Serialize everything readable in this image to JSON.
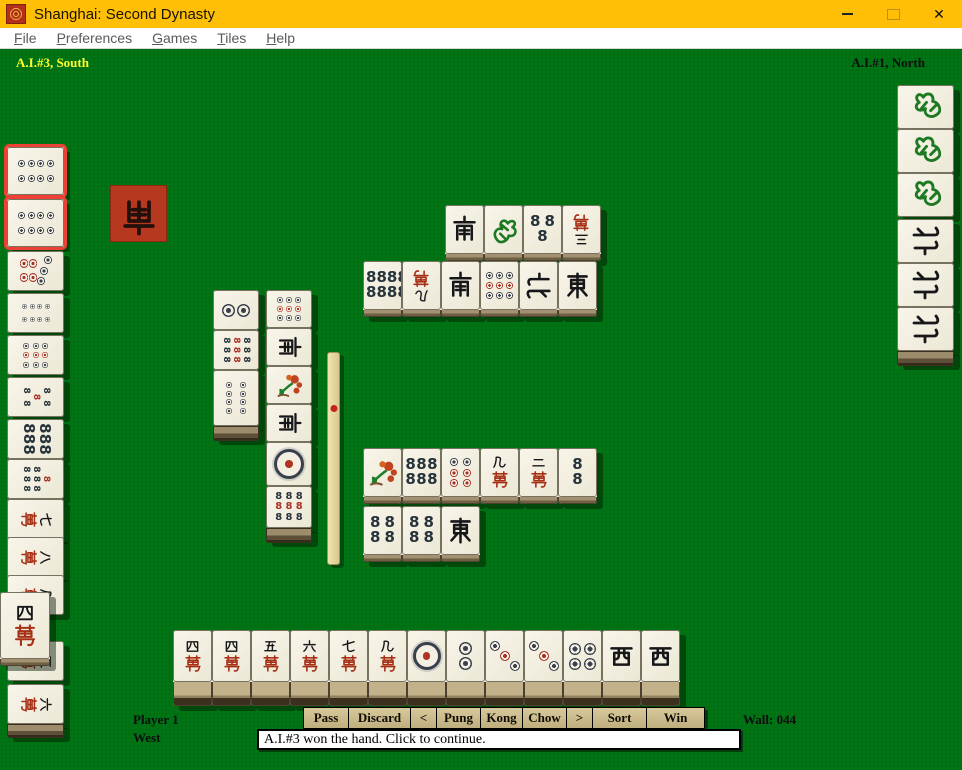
{
  "window": {
    "title": "Shanghai: Second Dynasty",
    "controls": [
      {
        "name": "minimize"
      },
      {
        "name": "maximize"
      },
      {
        "name": "close"
      }
    ]
  },
  "menu": {
    "items": [
      "File",
      "Preferences",
      "Games",
      "Tiles",
      "Help"
    ]
  },
  "hud": {
    "south_label": "A.I.#3, South",
    "north_label": "A.I.#1, North",
    "player_name": "Player 1",
    "player_wind": "West",
    "wall_label": "Wall: 044"
  },
  "actions": {
    "buttons": [
      "Pass",
      "Discard",
      "<",
      "Pung",
      "Kong",
      "Chow",
      ">",
      "Sort",
      "Win"
    ]
  },
  "status": {
    "message": "A.I.#3 won the hand. Click to continue."
  },
  "colors": {
    "felt": "#007314",
    "titlebar": "#ffbf06",
    "button_face": "#c9b88a",
    "tile_face": "#f2efe0",
    "highlight_red": "#ee4135",
    "indicator_red": "#b5381f",
    "glyph_red": "#a63117",
    "glyph_green": "#1d7a23"
  },
  "legend": {
    "m1": "1-man",
    "m2": "2-man",
    "m3": "3-man",
    "m4": "4-man",
    "m5": "5-man",
    "m6": "6-man",
    "m7": "7-man",
    "m8": "8-man",
    "m9": "9-man",
    "d1": "1-dot",
    "d2": "2-dot",
    "d3": "3-dot",
    "d4": "4-dot",
    "d6": "6-dot",
    "d7": "7-dot",
    "d8": "8-dot",
    "d9": "9-dot",
    "b2": "2-bamboo",
    "b3": "3-bamboo",
    "b4": "4-bamboo",
    "b5": "5-bamboo",
    "b6": "6-bamboo",
    "b7": "7-bamboo",
    "b8": "8-bamboo",
    "b9": "9-bamboo",
    "E": "east-wind",
    "S": "south-wind",
    "W": "west-wind",
    "N": "north-wind",
    "F": "green-dragon",
    "FL": "flower"
  },
  "indicator": {
    "x": 110,
    "y": 185,
    "size": 57,
    "face": "S",
    "rot": 180
  },
  "stick": {
    "x": 327,
    "y": 352,
    "w": 13,
    "h": 213,
    "dot_offset": 52
  },
  "tile_groups": [
    {
      "name": "south-exposed-hand",
      "kind": "stack",
      "tile_w": 57,
      "tile_h": 40,
      "rot": 90,
      "interactable": false,
      "tiles": [
        {
          "x": 7,
          "y": 147,
          "f": "d8",
          "hl": true,
          "h": 48
        },
        {
          "x": 7,
          "y": 199,
          "f": "d8",
          "hl": true,
          "h": 48
        },
        {
          "x": 7,
          "y": 251,
          "f": "d7"
        },
        {
          "x": 7,
          "y": 293,
          "f": "d8"
        },
        {
          "x": 7,
          "y": 335,
          "f": "d9"
        },
        {
          "x": 7,
          "y": 377,
          "f": "b5"
        },
        {
          "x": 7,
          "y": 419,
          "f": "b6"
        },
        {
          "x": 7,
          "y": 459,
          "f": "b7"
        },
        {
          "x": 7,
          "y": 499,
          "f": "m7"
        },
        {
          "x": 7,
          "y": 537,
          "f": "m8"
        },
        {
          "x": 7,
          "y": 575,
          "f": "m9"
        },
        {
          "x": 7,
          "y": 641,
          "f": "m5"
        },
        {
          "x": 7,
          "y": 684,
          "f": "m6"
        }
      ],
      "base": {
        "x": 7,
        "y": 724,
        "w": 57,
        "h": 14
      }
    },
    {
      "name": "south-winning-tile",
      "kind": "flat",
      "tile_w": 50,
      "tile_h": 74,
      "interactable": false,
      "tiles": [
        {
          "x": 0,
          "y": 592,
          "f": "m4"
        }
      ]
    },
    {
      "name": "north-exposed-hand",
      "kind": "stack",
      "tile_w": 57,
      "tile_h": 44,
      "rot": -90,
      "interactable": false,
      "tiles": [
        {
          "x": 897,
          "y": 85,
          "f": "F"
        },
        {
          "x": 897,
          "y": 129,
          "f": "F"
        },
        {
          "x": 897,
          "y": 173,
          "f": "F"
        },
        {
          "x": 897,
          "y": 219,
          "f": "N"
        },
        {
          "x": 897,
          "y": 263,
          "f": "N"
        },
        {
          "x": 897,
          "y": 307,
          "f": "N"
        }
      ],
      "base": {
        "x": 897,
        "y": 351,
        "w": 57,
        "h": 15
      }
    },
    {
      "name": "west-meld-column-a",
      "kind": "stack",
      "tile_w": 46,
      "tile_h": 40,
      "interactable": false,
      "tiles": [
        {
          "x": 213,
          "y": 290,
          "f": "d2",
          "r": 90
        },
        {
          "x": 213,
          "y": 330,
          "f": "b9",
          "r": 90
        },
        {
          "x": 213,
          "y": 370,
          "f": "d8",
          "h": 56
        }
      ],
      "base": {
        "x": 213,
        "y": 426,
        "w": 46,
        "h": 15
      }
    },
    {
      "name": "west-meld-column-b",
      "kind": "stack",
      "tile_w": 46,
      "tile_h": 38,
      "interactable": false,
      "tiles": [
        {
          "x": 266,
          "y": 290,
          "f": "d9",
          "r": 90
        },
        {
          "x": 266,
          "y": 328,
          "f": "S",
          "r": 90
        },
        {
          "x": 266,
          "y": 366,
          "f": "FL"
        },
        {
          "x": 266,
          "y": 404,
          "f": "S",
          "r": 90
        },
        {
          "x": 266,
          "y": 442,
          "f": "d1",
          "h": 44
        },
        {
          "x": 266,
          "y": 486,
          "f": "b9",
          "h": 42
        }
      ],
      "base": {
        "x": 266,
        "y": 528,
        "w": 46,
        "h": 15
      }
    },
    {
      "name": "north-discards",
      "kind": "flat",
      "tile_w": 39,
      "tile_h": 56,
      "interactable": false,
      "tiles": [
        {
          "x": 445,
          "y": 205,
          "f": "S"
        },
        {
          "x": 484,
          "y": 205,
          "f": "F"
        },
        {
          "x": 523,
          "y": 205,
          "f": "b3"
        },
        {
          "x": 562,
          "y": 205,
          "f": "m3",
          "r": 180
        },
        {
          "x": 363,
          "y": 261,
          "f": "b8"
        },
        {
          "x": 402,
          "y": 261,
          "f": "m9",
          "r": 180
        },
        {
          "x": 441,
          "y": 261,
          "f": "S"
        },
        {
          "x": 480,
          "y": 261,
          "f": "d9",
          "r": 90
        },
        {
          "x": 519,
          "y": 261,
          "f": "N",
          "r": 90
        },
        {
          "x": 558,
          "y": 261,
          "f": "E"
        }
      ]
    },
    {
      "name": "west-discards",
      "kind": "flat",
      "tile_w": 39,
      "tile_h": 56,
      "interactable": false,
      "tiles": [
        {
          "x": 363,
          "y": 448,
          "f": "FL"
        },
        {
          "x": 402,
          "y": 448,
          "f": "b6"
        },
        {
          "x": 441,
          "y": 448,
          "f": "d6"
        },
        {
          "x": 480,
          "y": 448,
          "f": "m9"
        },
        {
          "x": 519,
          "y": 448,
          "f": "m2"
        },
        {
          "x": 558,
          "y": 448,
          "f": "b2"
        },
        {
          "x": 363,
          "y": 506,
          "f": "b4"
        },
        {
          "x": 402,
          "y": 506,
          "f": "b4"
        },
        {
          "x": 441,
          "y": 506,
          "f": "E"
        }
      ]
    },
    {
      "name": "player-hand",
      "kind": "hand",
      "tile_w": 39,
      "tile_h": 76,
      "interactable": true,
      "tiles": [
        {
          "x": 173,
          "y": 630,
          "f": "m4"
        },
        {
          "x": 212,
          "y": 630,
          "f": "m4"
        },
        {
          "x": 251,
          "y": 630,
          "f": "m5"
        },
        {
          "x": 290,
          "y": 630,
          "f": "m6"
        },
        {
          "x": 329,
          "y": 630,
          "f": "m7"
        },
        {
          "x": 368,
          "y": 630,
          "f": "m9"
        },
        {
          "x": 407,
          "y": 630,
          "f": "d1"
        },
        {
          "x": 446,
          "y": 630,
          "f": "d2"
        },
        {
          "x": 485,
          "y": 630,
          "f": "d3"
        },
        {
          "x": 524,
          "y": 630,
          "f": "d3"
        },
        {
          "x": 563,
          "y": 630,
          "f": "d4"
        },
        {
          "x": 602,
          "y": 630,
          "f": "W"
        },
        {
          "x": 641,
          "y": 630,
          "f": "W"
        }
      ]
    }
  ]
}
